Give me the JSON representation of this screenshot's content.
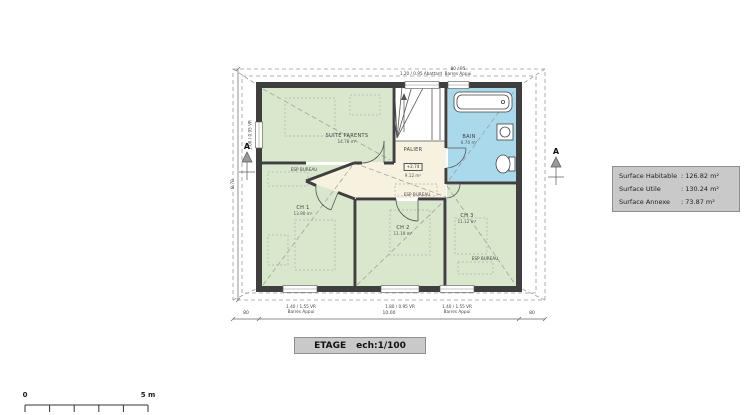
{
  "plan": {
    "rooms": [
      {
        "id": "suite-parents",
        "name": "SUITE PARENTS",
        "area": "14.78 m²"
      },
      {
        "id": "palier",
        "name": "PALIER",
        "level": "+2.74",
        "area": "9.12 m²"
      },
      {
        "id": "bain",
        "name": "BAIN",
        "area": "6.70 m²"
      },
      {
        "id": "ch1",
        "name": "CH 1",
        "area": "13.90 m²"
      },
      {
        "id": "ch2",
        "name": "CH 2",
        "area": "11.19 m²"
      },
      {
        "id": "ch3",
        "name": "CH 3",
        "area": "11.12 m²"
      }
    ],
    "annotations": {
      "esp_bureau": "ESP BUREAU",
      "window_top_left": "1.20 / 0.95 Abattant",
      "window_top_right_l1": "80 / 95",
      "window_top_right_l2": "Barres Appui",
      "window_left": "1.00 / 0.95 VR",
      "window_bottom_left_l1": "1.40 / 1.55 VR",
      "window_bottom_left_l2": "Barres Appui",
      "window_bottom_mid": "1.80 / 0.95 VR",
      "window_bottom_right_l1": "1.40 / 1.55 VR",
      "window_bottom_right_l2": "Barres Appui"
    },
    "dimensions": {
      "bottom_left": "80",
      "bottom_center": "10.00",
      "bottom_right": "80",
      "left": "8.70"
    },
    "sections": {
      "left": "A",
      "right": "A"
    }
  },
  "surface_table": {
    "rows": [
      {
        "label": "Surface Habitable",
        "value": ": 126.82 m²"
      },
      {
        "label": "Surface Utile",
        "value": ": 130.24 m²"
      },
      {
        "label": "Surface  Annexe",
        "value": ": 73.87 m²"
      }
    ]
  },
  "title_block": {
    "title": "ETAGE",
    "scale": "ech:1/100"
  },
  "scale_bar": {
    "zero": "0",
    "five": "5 m"
  }
}
